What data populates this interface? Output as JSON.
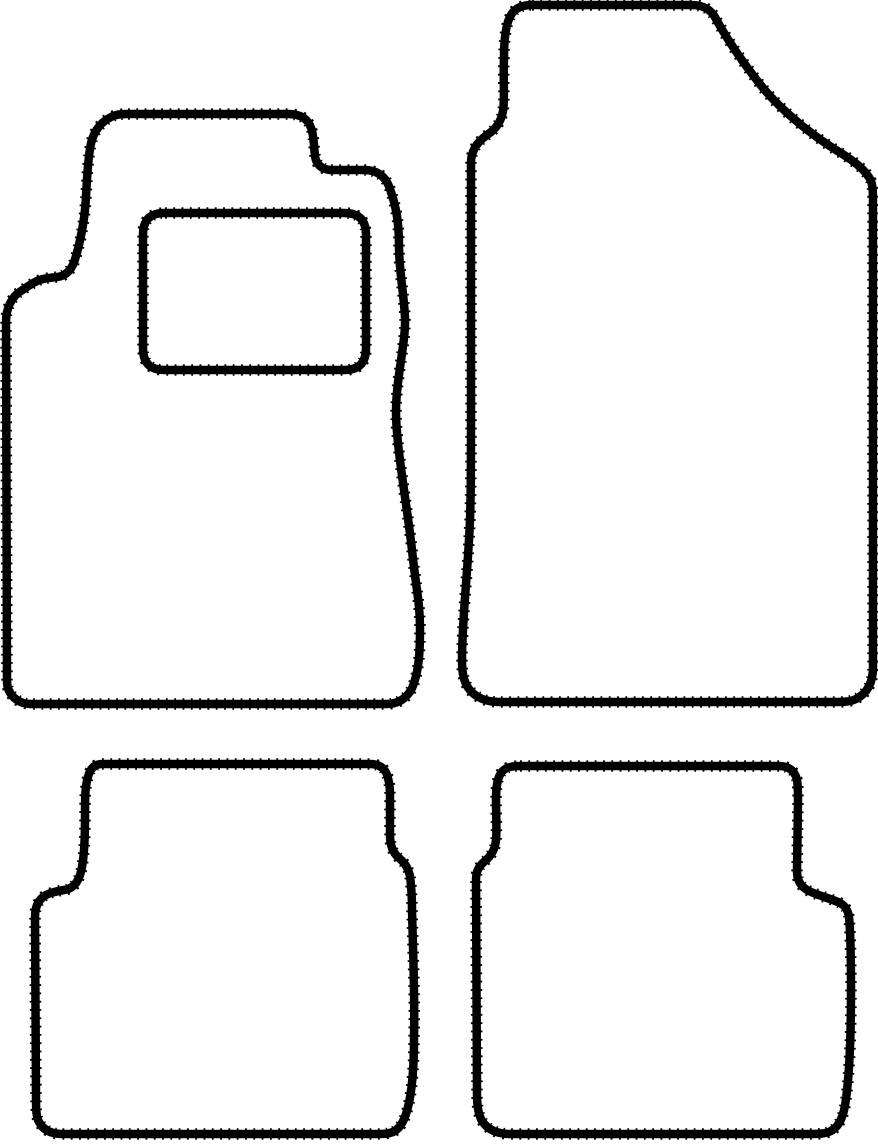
{
  "drawing": {
    "description": "Outline template drawing of a four-piece tailored car floor mat set: front left mat with heel pad rectangle, front right mat with tunnel neck, and two notched rear mats",
    "canvas": {
      "width": 878,
      "height": 1144
    },
    "background_color": "#ffffff",
    "stroke": {
      "color": "#000000",
      "width": 8.5,
      "serration_width": 11.5,
      "serration_dash": "1.8 6.5"
    },
    "mats": [
      {
        "id": "front-left-mat",
        "label": "Front left mat (with heel pad)",
        "paths": [
          "M 128 114 L 288 114 C 301 114 309 119 312 131 C 314 139 314 148 315 156 C 316 164 321 169 330 170 L 364 170 C 378 170 386 177 390 189 C 396 206 399 222 399 246 C 399 271 404 294 405 318 C 406 341 396 379 396 412 C 396 445 407 505 412 550 C 416 588 420 603 420 628 C 420 652 419 668 414 683 C 410 696 400 704 387 704 L 31 704 C 18 704 7 695 7 681 L 6 322 C 6 309 11 297 21 291 C 30 285 37 279 49 278 L 57 277 C 67 276 73 268 76 256 C 80 243 82 232 84 218 C 87 198 86 174 90 149 C 92 134 99 123 111 117 C 117 114 122 114 128 114 Z",
          "M 165 213 L 344 213 C 359 213 366 220 366 235 L 366 348 C 366 363 359 370 344 370 L 165 370 C 150 370 143 363 143 348 L 143 235 C 143 220 150 213 165 213 Z"
        ]
      },
      {
        "id": "front-right-mat",
        "label": "Front right mat",
        "paths": [
          "M 532 5 L 691 5 C 703 5 711 9 716 19 C 727 39 743 63 763 88 C 783 112 812 135 836 150 C 854 161 866 170 871 181 C 873 187 873 194 873 203 L 873 667 C 873 682 868 693 856 699 C 850 702 842 702 834 702 L 499 702 C 487 702 476 698 469 689 C 463 681 462 671 462 660 C 462 620 468 571 470 520 C 471 494 471 459 471 420 L 471 163 C 471 151 477 142 487 135 C 496 129 501 122 503 111 C 505 99 503 82 504 58 C 504 39 506 23 511 15 C 515 8 522 5 532 5 Z"
        ]
      },
      {
        "id": "rear-left-mat",
        "label": "Rear left mat",
        "paths": [
          "M 102 764 L 370 764 C 380 764 386 769 388 778 C 390 785 390 792 390 800 L 390 835 C 390 846 393 853 399 858 C 405 863 408 868 410 876 C 411 884 412 896 412 910 C 413 950 415 998 414 1038 C 414 1073 411 1095 408 1107 C 405 1119 401 1128 393 1132 C 388 1134 383 1134 375 1134 L 62 1134 C 50 1134 42 1129 38 1120 C 36 1114 36 1107 36 1098 L 35 917 C 35 906 39 899 46 895 C 52 892 58 891 64 890 C 72 889 77 884 80 875 C 83 866 85 847 85 818 C 85 798 85 786 88 777 C 90 768 95 764 102 764 Z"
        ]
      },
      {
        "id": "rear-right-mat",
        "label": "Rear right mat",
        "paths": [
          "M 520 766 L 779 766 C 789 766 795 771 797 780 C 798 786 798 793 798 801 L 797 871 C 797 881 801 887 809 891 C 817 895 828 898 838 902 C 845 905 848 910 849 917 C 850 927 851 952 851 990 C 851 1029 850 1069 846 1099 C 844 1115 840 1126 831 1131 C 825 1134 818 1134 809 1134 L 510 1134 C 498 1134 488 1130 482 1121 C 478 1114 477 1105 477 1094 L 476 880 C 476 871 479 866 485 861 C 491 856 495 850 496 840 C 497 829 496 815 496 800 C 496 788 497 779 501 773 C 505 767 512 766 520 766 Z"
        ]
      }
    ]
  }
}
